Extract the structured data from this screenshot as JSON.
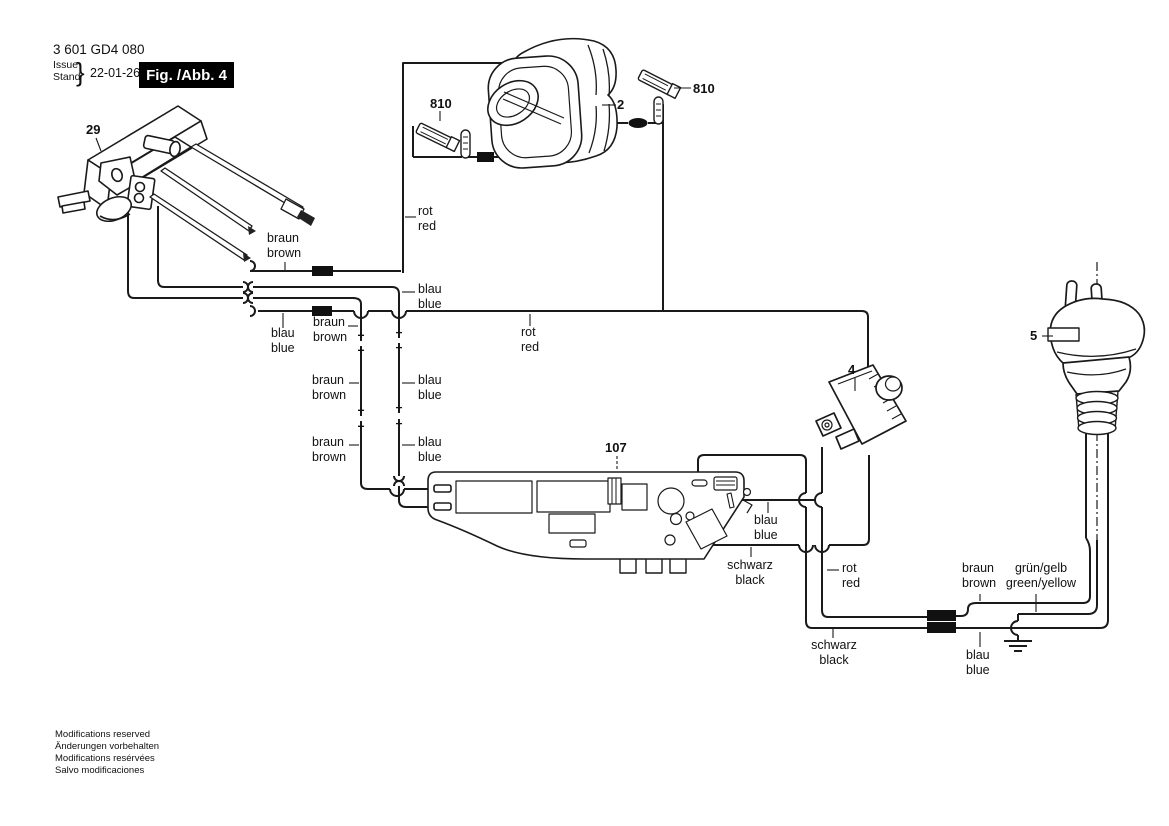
{
  "header": {
    "part_number": "3 601 GD4 080",
    "issue": "Issue",
    "stand": "Stand",
    "brace": "}",
    "date": "22-01-26",
    "figure": "Fig. /Abb. 4"
  },
  "part_labels": {
    "switch": "29",
    "brush_left": "810",
    "armature": "2",
    "brush_right": "810",
    "suppressor": "4",
    "plug": "5",
    "module": "107"
  },
  "wire_labels": {
    "rot_left": {
      "de": "rot",
      "en": "red"
    },
    "braun_top": {
      "de": "braun",
      "en": "brown"
    },
    "blau_switch": {
      "de": "blau",
      "en": "blue"
    },
    "braun_mid": {
      "de": "braun",
      "en": "brown"
    },
    "rot_mid": {
      "de": "rot",
      "en": "red"
    },
    "blau_mid": {
      "de": "blau",
      "en": "blue"
    },
    "braun_v1": {
      "de": "braun",
      "en": "brown"
    },
    "blau_v1": {
      "de": "blau",
      "en": "blue"
    },
    "braun_v2": {
      "de": "braun",
      "en": "brown"
    },
    "blau_v2": {
      "de": "blau",
      "en": "blue"
    },
    "blau_board": {
      "de": "blau",
      "en": "blue"
    },
    "schwarz_board": {
      "de": "schwarz",
      "en": "black"
    },
    "rot_right": {
      "de": "rot",
      "en": "red"
    },
    "schwarz_bottom": {
      "de": "schwarz",
      "en": "black"
    },
    "braun_plug": {
      "de": "braun",
      "en": "brown"
    },
    "gruen_plug": {
      "de": "grün/gelb",
      "en": "green/yellow"
    },
    "blau_plug": {
      "de": "blau",
      "en": "blue"
    }
  },
  "symbols": {
    "plus": "+",
    "minus": "−"
  },
  "footer": {
    "line1": "Modifications reserved",
    "line2": "Änderungen vorbehalten",
    "line3": "Modifications resérvées",
    "line4": "Salvo modificaciones"
  }
}
